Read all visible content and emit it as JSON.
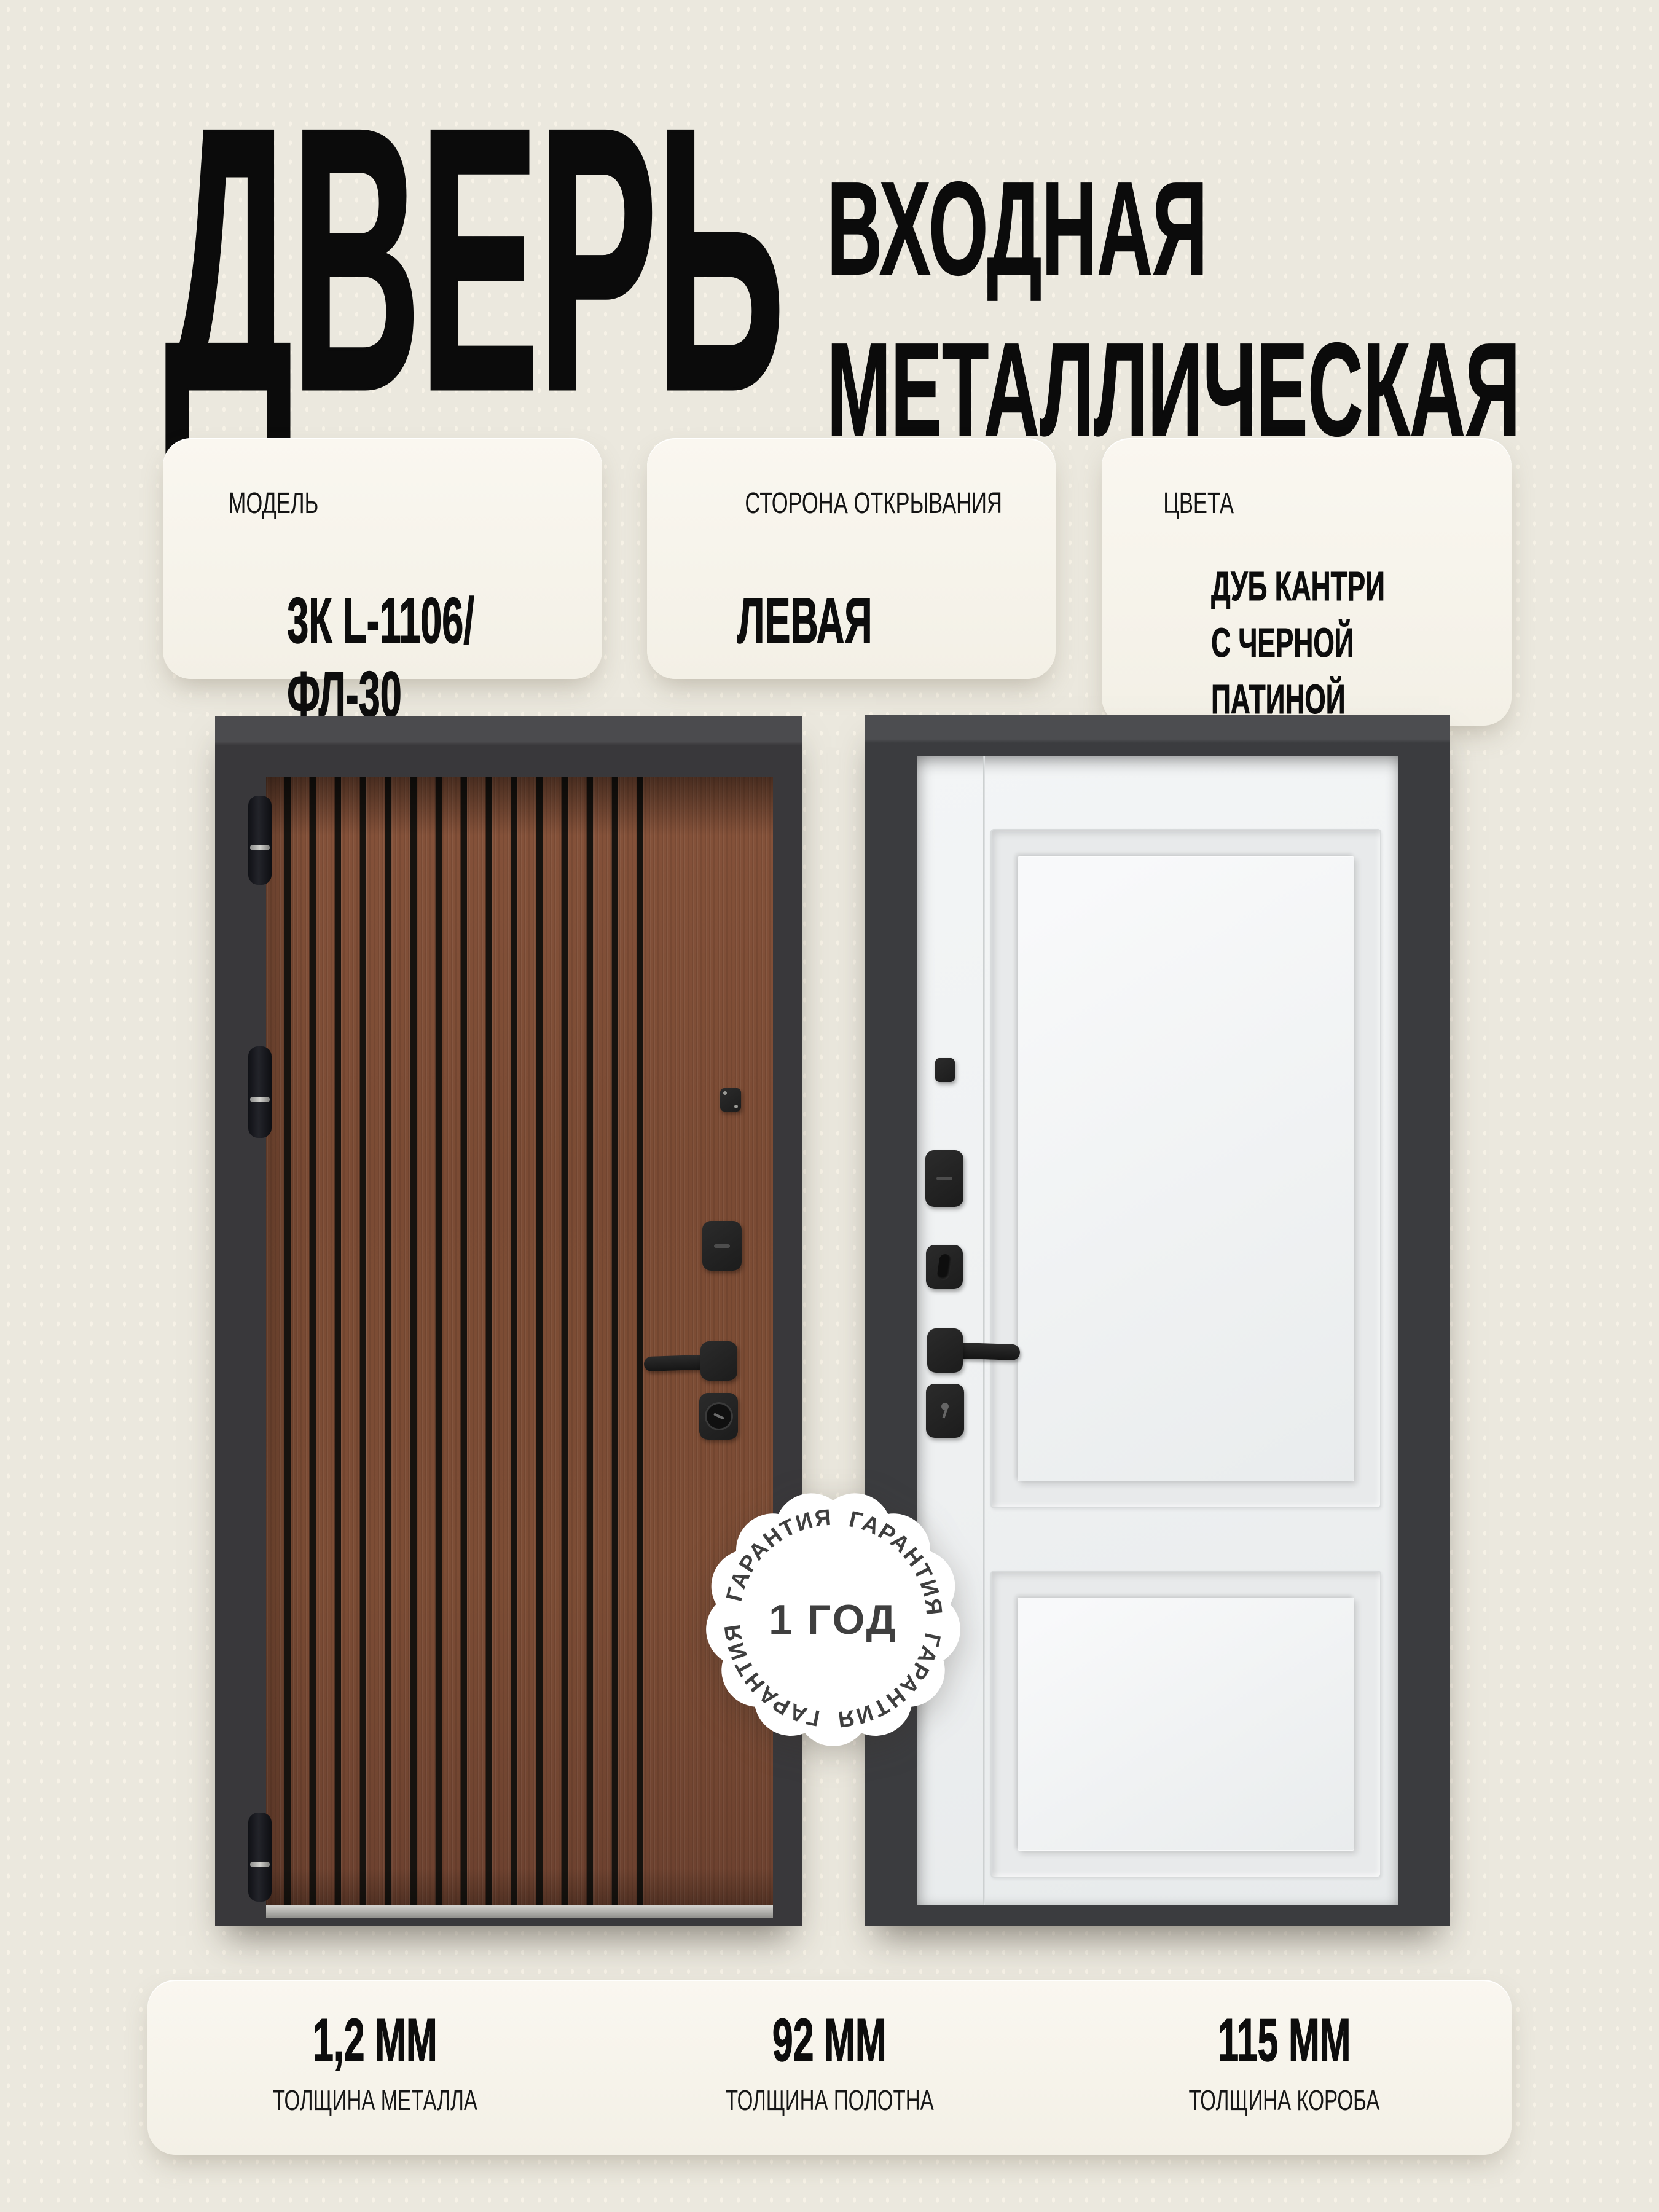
{
  "header": {
    "title": "ДВЕРЬ",
    "subtitle_line1": "ВХОДНАЯ",
    "subtitle_line2": "МЕТАЛЛИЧЕСКАЯ"
  },
  "info_cards": [
    {
      "label": "МОДЕЛЬ",
      "value": "3К L-1106/ФЛ-30"
    },
    {
      "label": "СТОРОНА ОТКРЫВАНИЯ",
      "value": "ЛЕВАЯ"
    },
    {
      "label": "ЦВЕТА",
      "value_lines": [
        "ДУБ КАНТРИ",
        "С ЧЕРНОЙ ПАТИНОЙ",
        "VELLUTO BIANCO"
      ]
    }
  ],
  "doors": {
    "left": {
      "finish": "ДУБ КАНТРИ С ЧЕРНОЙ ПАТИНОЙ"
    },
    "right": {
      "finish": "VELLUTO BIANCO"
    }
  },
  "badge": {
    "center_text": "1 ГОД",
    "ring_text": "ГАРАНТИЯ",
    "ring_repetitions": 4
  },
  "specs": [
    {
      "value": "1,2 ММ",
      "label": "ТОЛЩИНА МЕТАЛЛА"
    },
    {
      "value": "92 ММ",
      "label": "ТОЛЩИНА ПОЛОТНА"
    },
    {
      "value": "115 ММ",
      "label": "ТОЛЩИНА КОРОБА"
    }
  ],
  "colors": {
    "background": "#ebe8de",
    "text": "#0b0b0b",
    "card": "#f7f4ec",
    "frame": "#3a393c",
    "wood": "#7b4b34",
    "slat": "#17130f",
    "white_leaf": "#eef0f1",
    "hardware": "#1f1f1f",
    "badge_text": "#3f3f3f"
  }
}
